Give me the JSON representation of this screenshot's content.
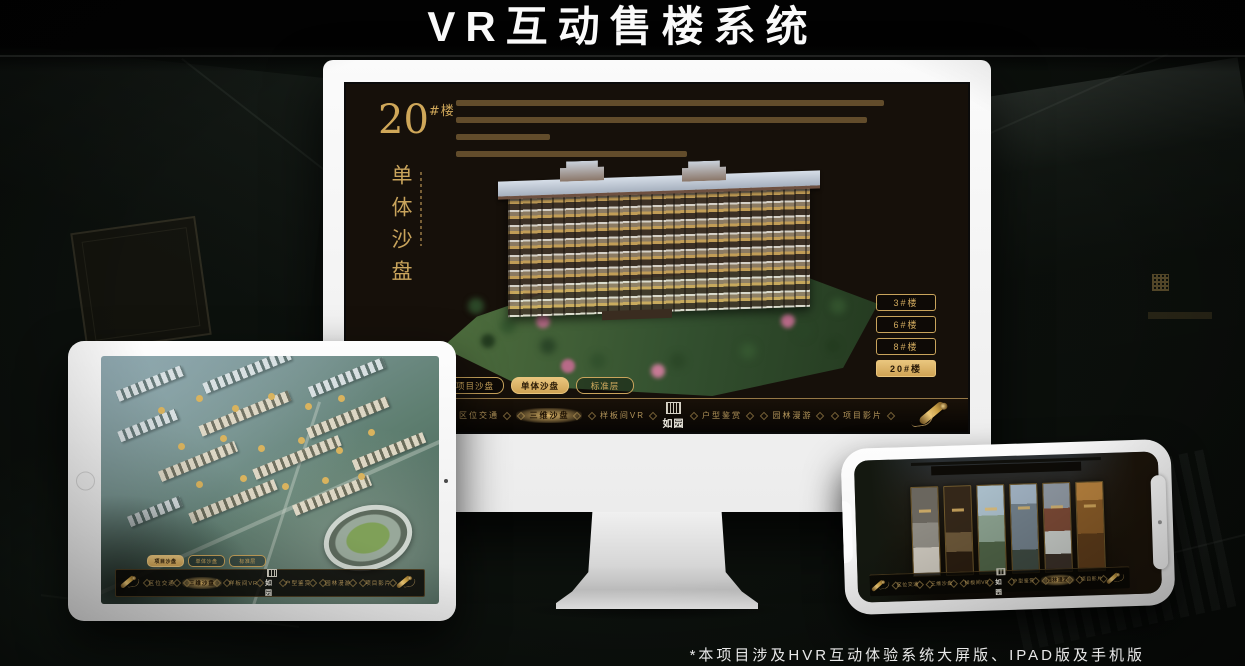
{
  "page": {
    "title": "VR互动售楼系统",
    "footnote": "*本项目涉及HVR互动体验系统大屏版、IPAD版及手机版"
  },
  "colors": {
    "gold": "#d2a85c",
    "gold_bright": "#e9c57d",
    "screen_bg": "#16100a",
    "device_body": "#f4f4f4"
  },
  "monitor": {
    "screen": {
      "building_title": "20",
      "building_title_suffix": "#楼",
      "subtitle": "单体沙盘",
      "floor_buttons": [
        {
          "label": "3#楼",
          "selected": false
        },
        {
          "label": "6#楼",
          "selected": false
        },
        {
          "label": "8#楼",
          "selected": false
        },
        {
          "label": "20#楼",
          "selected": true
        }
      ],
      "tabs": [
        {
          "label": "项目沙盘",
          "selected": false
        },
        {
          "label": "单体沙盘",
          "selected": true
        },
        {
          "label": "标准层",
          "selected": false
        }
      ],
      "nav": {
        "items": [
          {
            "label": "区位交通",
            "selected": false
          },
          {
            "label": "三维沙盘",
            "selected": true
          },
          {
            "label": "样板间VR",
            "selected": false
          },
          {
            "label": "户型鉴赏",
            "selected": false
          },
          {
            "label": "园林漫游",
            "selected": false
          },
          {
            "label": "项目影片",
            "selected": false
          }
        ],
        "logo": "如园"
      }
    }
  },
  "tablet": {
    "tabs": [
      {
        "label": "项目沙盘",
        "selected": true
      },
      {
        "label": "单体沙盘",
        "selected": false
      },
      {
        "label": "标准层",
        "selected": false
      }
    ],
    "nav": {
      "items": [
        {
          "label": "区位交通",
          "selected": false
        },
        {
          "label": "三维沙盘",
          "selected": true
        },
        {
          "label": "样板间VR",
          "selected": false
        },
        {
          "label": "户型鉴赏",
          "selected": false
        },
        {
          "label": "园林漫游",
          "selected": false
        },
        {
          "label": "项目影片",
          "selected": false
        }
      ],
      "logo": "如园"
    }
  },
  "phone": {
    "nav": {
      "items": [
        {
          "label": "区位交通",
          "selected": false
        },
        {
          "label": "三维沙盘",
          "selected": false
        },
        {
          "label": "样板间VR",
          "selected": false
        },
        {
          "label": "户型鉴赏",
          "selected": false
        },
        {
          "label": "园林漫游",
          "selected": true
        },
        {
          "label": "项目影片",
          "selected": false
        }
      ],
      "logo": "如园"
    }
  }
}
